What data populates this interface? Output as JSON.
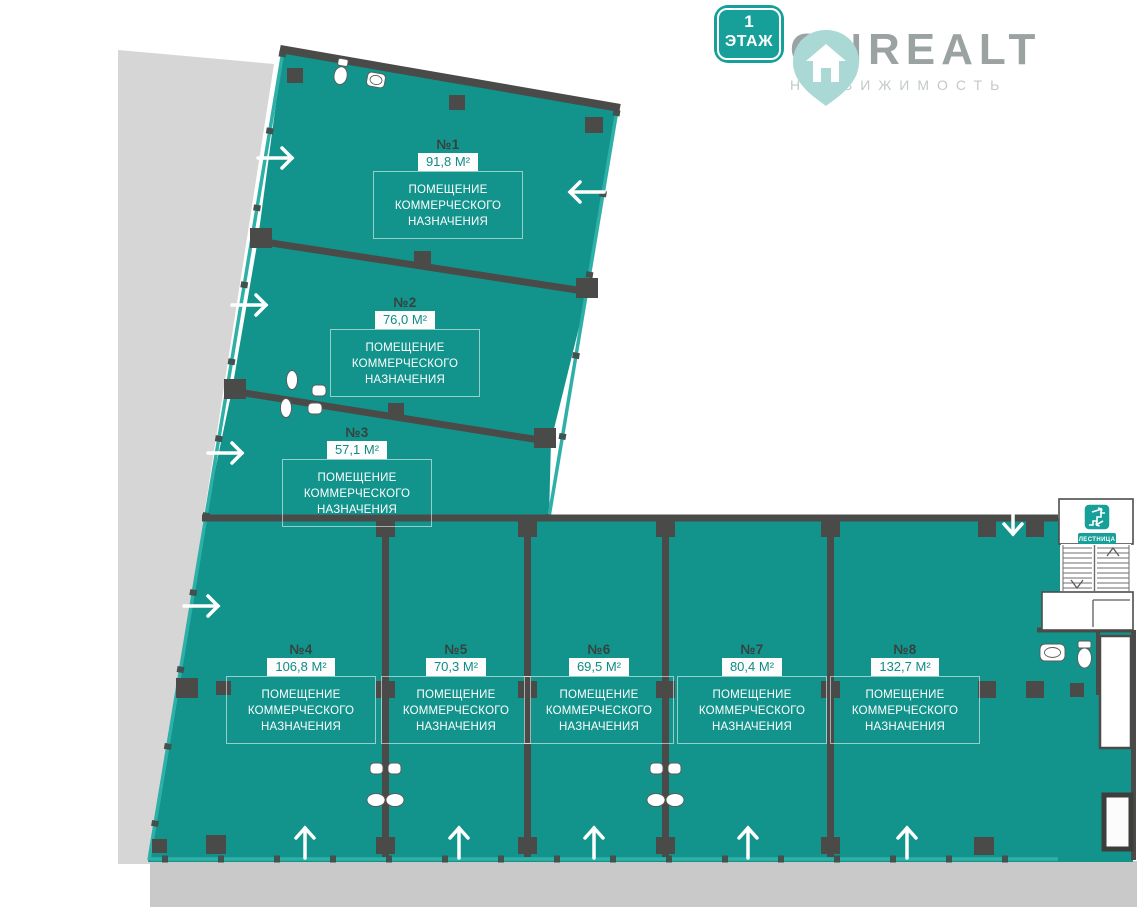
{
  "floor_badge": {
    "level": "1",
    "label": "ЭТАЖ"
  },
  "logo": {
    "name": "ONREALT",
    "subtitle": "НЕДВИЖИМОСТЬ"
  },
  "stairs": {
    "label": "ЛЕСТНИЦА"
  },
  "room_type": {
    "line1": "ПОМЕЩЕНИЕ",
    "line2": "КОММЕРЧЕСКОГО",
    "line3": "НАЗНАЧЕНИЯ"
  },
  "rooms": [
    {
      "number": "№1",
      "area": "91,8 М²"
    },
    {
      "number": "№2",
      "area": "76,0 М²"
    },
    {
      "number": "№3",
      "area": "57,1 М²"
    },
    {
      "number": "№4",
      "area": "106,8 М²"
    },
    {
      "number": "№5",
      "area": "70,3 М²"
    },
    {
      "number": "№6",
      "area": "69,5 М²"
    },
    {
      "number": "№7",
      "area": "80,4 М²"
    },
    {
      "number": "№8",
      "area": "132,7 М²"
    }
  ],
  "colors": {
    "floor_teal": "#12948d",
    "edge_teal": "#2fb0a7",
    "accent_teal": "#17a09a",
    "wall_dark": "#4a4b49",
    "site_gray": "#d6d6d6",
    "pavement_gray": "#c9c9c9"
  }
}
